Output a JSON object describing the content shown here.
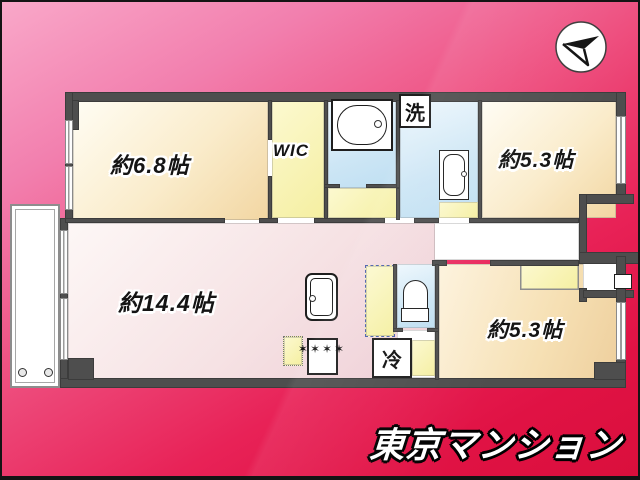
{
  "compass": {
    "icon_name": "north-arrow-compass"
  },
  "rooms": [
    {
      "name": "bedroom-west",
      "label": "約6.8帖"
    },
    {
      "name": "walk-in-closet",
      "label": "WIC"
    },
    {
      "name": "bedroom-northeast",
      "label": "約5.3帖"
    },
    {
      "name": "living-dining",
      "label": "約14.4帖"
    },
    {
      "name": "bedroom-southeast",
      "label": "約5.3帖"
    }
  ],
  "fixtures": {
    "washer_label": "洗",
    "fridge_label": "冷",
    "stove_burners": "✶✶✶✶"
  },
  "branding": {
    "logo_text": "東京マンション"
  },
  "colors": {
    "bg_top": "#f9a8c9",
    "bg_bottom": "#da0f3c",
    "wall": "#4e4e4e",
    "floor_cream": "#f2d6a2",
    "floor_pink": "#edccd4",
    "floor_yellow": "#f5efa1",
    "floor_blue": "#bfdff2"
  }
}
